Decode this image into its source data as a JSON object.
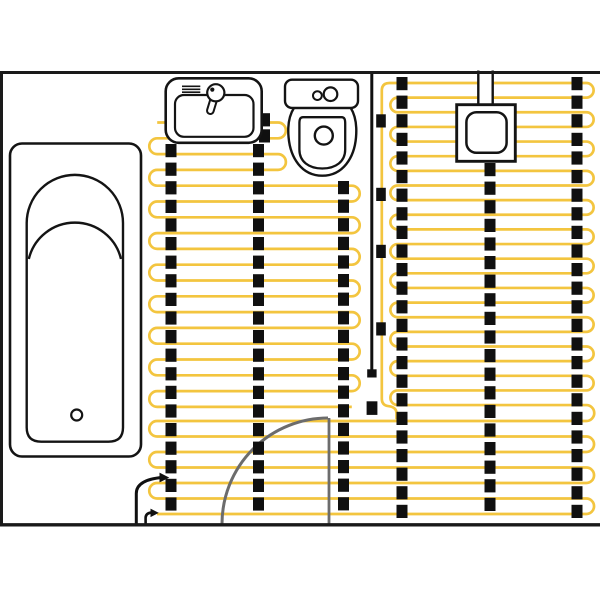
{
  "canvas": {
    "width": 600,
    "height": 600,
    "background": "#ffffff"
  },
  "palette": {
    "cable": "#F3C53F",
    "tape": "#101010",
    "wall": "#1A1A1A",
    "fixture_stroke": "#141414",
    "fixture_fill": "#FFFFFF",
    "door": "#6C6C6C"
  },
  "room": {
    "walls": [
      {
        "x1": 0,
        "y1": 72.5,
        "x2": 600,
        "y2": 72.5,
        "sw": 3
      },
      {
        "x1": 1.5,
        "y1": 71,
        "x2": 1.5,
        "y2": 526.2,
        "sw": 3
      },
      {
        "x1": 0,
        "y1": 524.8,
        "x2": 600,
        "y2": 524.8,
        "sw": 3.4
      }
    ]
  },
  "heating_system": {
    "cable_stroke_width": 2.7,
    "left_mat": {
      "y_start": 122.5,
      "pitch": 15.8,
      "row_count": 19,
      "x_left": 157.2,
      "x_right_short": 278,
      "x_right_full": 351.8,
      "short_row_count": 4
    },
    "right_mat_upper": {
      "y_start": 83,
      "pitch": 14.64,
      "row_count": 23,
      "x_left": 397.7,
      "x_right": 586.3
    },
    "right_mat_lower": {
      "y_start": 421,
      "pitch": 15.5,
      "row_count": 7,
      "x_left": 157,
      "x_right": 586.3
    },
    "feed_line": {
      "path": "M 397.7,83 H 389.5 Q 381.8,83 381.8,90.8 V 398.5 Q 381.8,405.6 388.8,406.2 Q 396.5,407.2 396.5,413.4 V 419.2"
    },
    "cold_lead": {
      "outer_path": "M 136.3,525 V 493.5 Q 136.3,479.8 162.5,477.4",
      "outer_arrow": "159.5,472.6 169.3,477.6 159.5,482.4",
      "inner_path": "M 145.6,525 V 517.8 Q 145.6,513 152,512.4",
      "inner_arrow": "150.5,508.6 158.8,512.9 150.5,517.1",
      "sw": 3
    },
    "floor_sensor": {
      "x": 371.8,
      "y1": 73.5,
      "y2": 369.8,
      "sw": 3,
      "end_cap": {
        "x": 367.2,
        "y": 369.3,
        "w": 9.4,
        "h": 8.2
      },
      "clips": [
        {
          "x": 376.2,
          "y": 114.3,
          "w": 9.6,
          "h": 13.2
        },
        {
          "x": 376.2,
          "y": 187.8,
          "w": 9.6,
          "h": 13.2
        },
        {
          "x": 376.2,
          "y": 244.8,
          "w": 9.6,
          "h": 13.2
        },
        {
          "x": 376.2,
          "y": 322.3,
          "w": 9.6,
          "h": 13.2
        },
        {
          "x": 366.6,
          "y": 401.3,
          "w": 10.8,
          "h": 13.6
        }
      ]
    },
    "tape": {
      "square_w": 11,
      "square_h": 13.2,
      "pitch": 18.6,
      "columns": [
        {
          "x": 171,
          "y1": 144,
          "y2": 519
        },
        {
          "x": 258.5,
          "y1": 144,
          "y2": 519
        },
        {
          "x": 343.5,
          "y1": 181,
          "y2": 519
        },
        {
          "x": 402,
          "y1": 77,
          "y2": 519
        },
        {
          "x": 490,
          "y1": 163,
          "y2": 519
        },
        {
          "x": 577,
          "y1": 77,
          "y2": 519
        }
      ],
      "extra_squares": [
        {
          "x": 264.5,
          "y": 113.2
        },
        {
          "x": 264.5,
          "y": 129.3
        }
      ]
    }
  },
  "fixtures": {
    "bathtub": {
      "shapes": [
        {
          "type": "rect",
          "x": 10,
          "y": 143.5,
          "w": 131,
          "h": 313,
          "rx": 12,
          "fill": "$fixture_fill",
          "stroke": "$fixture_stroke",
          "sw": 2.6
        },
        {
          "type": "path",
          "d": "M 26.7,223 A 48.15 48.15 0 0 1 123,223 L 123,427.5 Q 123,441.7 108.5,441.7 L 41.2,441.7 Q 26.7,441.7 26.7,427.5 Z",
          "fill": "$fixture_fill",
          "stroke": "$fixture_stroke",
          "sw": 2.4
        },
        {
          "type": "path",
          "d": "M 28.8,259 A 47.4 47.4 0 0 1 121,259",
          "fill": "none",
          "stroke": "$fixture_stroke",
          "sw": 2.4
        },
        {
          "type": "circle",
          "cx": 76.7,
          "cy": 415,
          "r": 5.5,
          "fill": "$fixture_fill",
          "stroke": "$fixture_stroke",
          "sw": 2.2
        }
      ]
    },
    "sink": {
      "shapes": [
        {
          "type": "rect",
          "x": 165.7,
          "y": 78.3,
          "w": 96,
          "h": 64.5,
          "rx": 13,
          "fill": "$fixture_fill",
          "stroke": "$fixture_stroke",
          "sw": 2.6
        },
        {
          "type": "rect",
          "x": 175,
          "y": 95,
          "w": 78.5,
          "h": 41.8,
          "rx": 9,
          "fill": "$fixture_fill",
          "stroke": "$fixture_stroke",
          "sw": 2.2
        },
        {
          "type": "line",
          "x1": 182,
          "y1": 86.3,
          "x2": 200.3,
          "y2": 86.3,
          "stroke": "$fixture_stroke",
          "sw": 1.6
        },
        {
          "type": "line",
          "x1": 182,
          "y1": 89.3,
          "x2": 200.3,
          "y2": 89.3,
          "stroke": "$fixture_stroke",
          "sw": 1.6
        },
        {
          "type": "line",
          "x1": 182,
          "y1": 92.2,
          "x2": 200.3,
          "y2": 92.2,
          "stroke": "$fixture_stroke",
          "sw": 1.6
        },
        {
          "type": "rect",
          "x": -3.3,
          "y": -2,
          "w": 6.6,
          "h": 24,
          "rx": 3.3,
          "fill": "$fixture_fill",
          "stroke": "$fixture_stroke",
          "sw": 2,
          "transform": "translate(215.8,92.8) rotate(17)"
        },
        {
          "type": "circle",
          "cx": 215.8,
          "cy": 92.8,
          "r": 8.6,
          "fill": "$fixture_fill",
          "stroke": "$fixture_stroke",
          "sw": 2.2
        },
        {
          "type": "circle",
          "cx": 212.3,
          "cy": 89.6,
          "r": 2.1,
          "fill": "$fixture_stroke",
          "stroke": "none",
          "sw": 0
        }
      ]
    },
    "toilet": {
      "shapes": [
        {
          "type": "path",
          "d": "M 294,107.9 C 288.8,116 287.5,126 288.6,137.5 C 290.4,157.5 301.5,175.7 322.3,175.7 C 343,175.7 354.3,157.5 356,137.5 C 357,126 355.8,116 350.7,107.9 Z",
          "fill": "$fixture_fill",
          "stroke": "$fixture_stroke",
          "sw": 2.4
        },
        {
          "type": "rect",
          "x": 285,
          "y": 79.7,
          "w": 73,
          "h": 28.2,
          "rx": 7,
          "fill": "$fixture_fill",
          "stroke": "$fixture_stroke",
          "sw": 2.4
        },
        {
          "type": "circle",
          "cx": 317.4,
          "cy": 95.6,
          "r": 4.4,
          "fill": "$fixture_fill",
          "stroke": "$fixture_stroke",
          "sw": 2
        },
        {
          "type": "circle",
          "cx": 330.5,
          "cy": 94.2,
          "r": 6.8,
          "fill": "$fixture_fill",
          "stroke": "$fixture_stroke",
          "sw": 2.2
        },
        {
          "type": "path",
          "d": "M 303.5,117.2 L 341.5,117.2 C 344.6,117.2 345.2,119.5 345.2,123.5 L 345.2,149.5 C 345.2,161.5 335.8,168.5 322.3,168.5 C 308.8,168.5 299.4,161.5 299.4,149.5 L 299.4,123.5 C 299.4,119.5 300,117.2 303.1,117.2 Z",
          "fill": "$fixture_fill",
          "stroke": "$fixture_stroke",
          "sw": 2.3
        },
        {
          "type": "circle",
          "cx": 323.8,
          "cy": 135.6,
          "r": 9,
          "fill": "$fixture_fill",
          "stroke": "$fixture_stroke",
          "sw": 2.4
        }
      ]
    },
    "junction_box": {
      "shapes": [
        {
          "type": "rect",
          "x": 478.3,
          "y": 70,
          "w": 14.4,
          "h": 36,
          "rx": 0,
          "fill": "$fixture_fill",
          "stroke": "none",
          "sw": 0
        },
        {
          "type": "line",
          "x1": 478.3,
          "y1": 70.5,
          "x2": 478.3,
          "y2": 105,
          "stroke": "$fixture_stroke",
          "sw": 2.4
        },
        {
          "type": "line",
          "x1": 492.7,
          "y1": 70.5,
          "x2": 492.7,
          "y2": 105,
          "stroke": "$fixture_stroke",
          "sw": 2.4
        },
        {
          "type": "rect",
          "x": 456.7,
          "y": 104.7,
          "w": 58.6,
          "h": 56.6,
          "rx": 0,
          "fill": "$fixture_fill",
          "stroke": "$fixture_stroke",
          "sw": 2.9
        },
        {
          "type": "rect",
          "x": 466.4,
          "y": 112.2,
          "w": 40.2,
          "h": 40.6,
          "rx": 10,
          "fill": "$fixture_fill",
          "stroke": "$fixture_stroke",
          "sw": 2.5
        }
      ]
    },
    "door": {
      "swing_arc": "M 222,524 A 106 106 0 0 1 328,418",
      "leaf": {
        "x1": 329,
        "y1": 418,
        "x2": 329,
        "y2": 524.5
      },
      "sw": 3
    }
  }
}
